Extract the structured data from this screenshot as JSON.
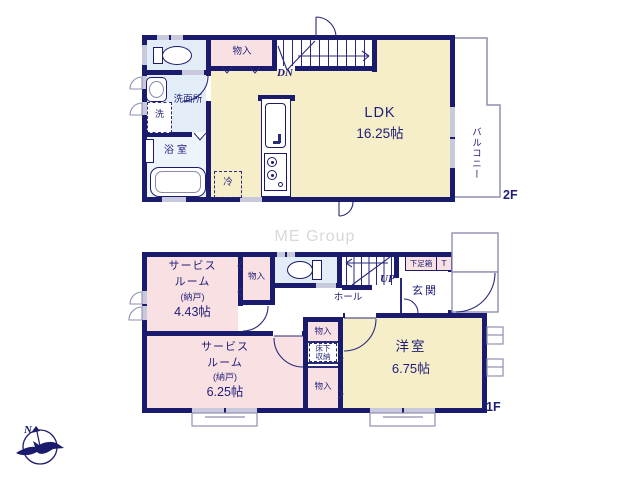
{
  "watermark": "ME Group",
  "compass": {
    "north": "N"
  },
  "floor2": {
    "label": "2F",
    "ldk": {
      "name": "LDK",
      "size": "16.25帖"
    },
    "storage": {
      "label": "物入"
    },
    "washroom": {
      "label": "洗面所"
    },
    "washer": {
      "label": "洗"
    },
    "bathroom": {
      "label": "浴室"
    },
    "fridge": {
      "label": "冷"
    },
    "stairs": {
      "label": "DN"
    },
    "balcony": {
      "label": "バルコニー"
    }
  },
  "floor1": {
    "label": "1F",
    "service_room_1": {
      "line1": "サービス",
      "line2": "ルーム",
      "line3": "(納戸)",
      "size": "4.43帖"
    },
    "service_room_2": {
      "line1": "サービス",
      "line2": "ルーム",
      "line3": "(納戸)",
      "size": "6.25帖"
    },
    "western_room": {
      "name": "洋室",
      "size": "6.75帖"
    },
    "entrance": {
      "label": "玄関"
    },
    "hall": {
      "label": "ホール"
    },
    "shoe_cabinet": {
      "label": "下足箱"
    },
    "t_cabinet": {
      "label": "T"
    },
    "stairs": {
      "label": "UP"
    },
    "storage_hall": {
      "label": "物入"
    },
    "storage_mid": {
      "label": "物入"
    },
    "storage_lower": {
      "label": "物入"
    },
    "underfloor_storage": {
      "line1": "床下",
      "line2": "収納"
    }
  },
  "colors": {
    "wall_navy": "#1b1b6e",
    "room_pink": "#f9e0e3",
    "room_cream": "#f6edc9",
    "room_blue": "#e2edf7",
    "bath_blue": "#edf4fb",
    "outline_gray": "#8f8fb1",
    "window_gray": "#c9c9dd",
    "watermark_gray": "#d8d8d8",
    "text_navy": "#1e1e78"
  }
}
